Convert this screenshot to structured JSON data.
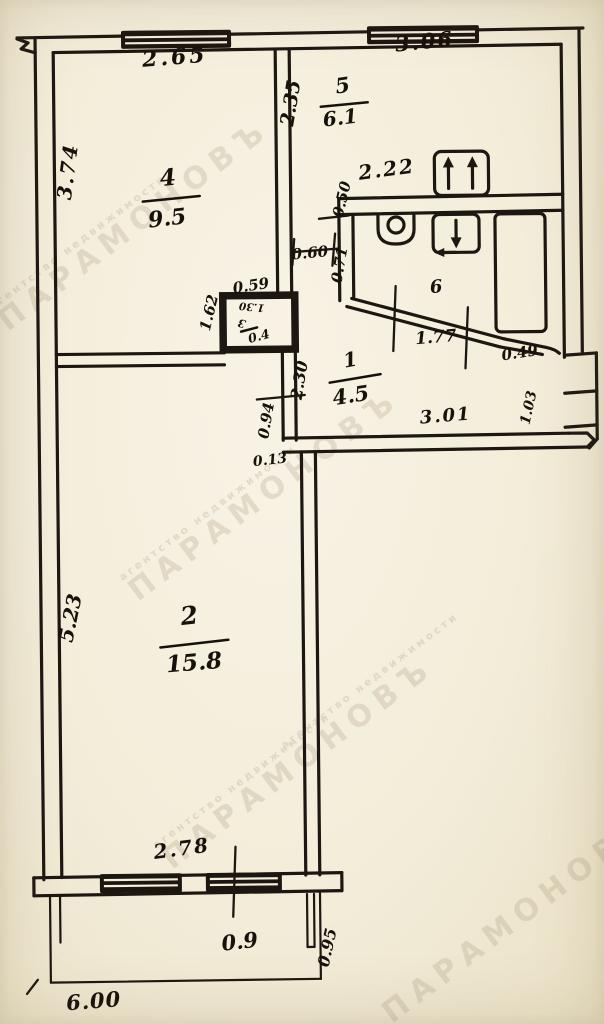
{
  "plan": {
    "watermark": {
      "agency_name": "ПАРАМОНОВЪ",
      "agency_tagline": "агентство недвижимости"
    },
    "rooms": {
      "room1": {
        "number": "1",
        "area": "4.5"
      },
      "room2": {
        "number": "2",
        "area": "15.8"
      },
      "room3": {
        "number": "3",
        "area": "0.4",
        "inner_dim": "1.30"
      },
      "room4": {
        "number": "4",
        "area": "9.5"
      },
      "room5": {
        "number": "5",
        "area": "6.1"
      },
      "room6": {
        "number": "6"
      },
      "balcony": {
        "area": "0.9"
      }
    },
    "dims": {
      "win_room4": "2.65",
      "win_room5": "3.06",
      "room4_left": "3.74",
      "room5_left": "2.35",
      "kitchen_width": "2.22",
      "vent_drop": "0.50",
      "passage_width": "0.60",
      "bath_wall": "0.71",
      "closet_width": "0.59",
      "closet_height": "1.62",
      "corridor_len": "2.30",
      "bath_diag": "1.77",
      "diag_tail": "0.49",
      "hall_width": "3.01",
      "entry_depth": "1.03",
      "door_width": "0.94",
      "wall_offset": "0.13",
      "room2_left": "5.23",
      "room2_win": "2.78",
      "balcony_depth": "0.95",
      "total_width": "6.00"
    }
  }
}
